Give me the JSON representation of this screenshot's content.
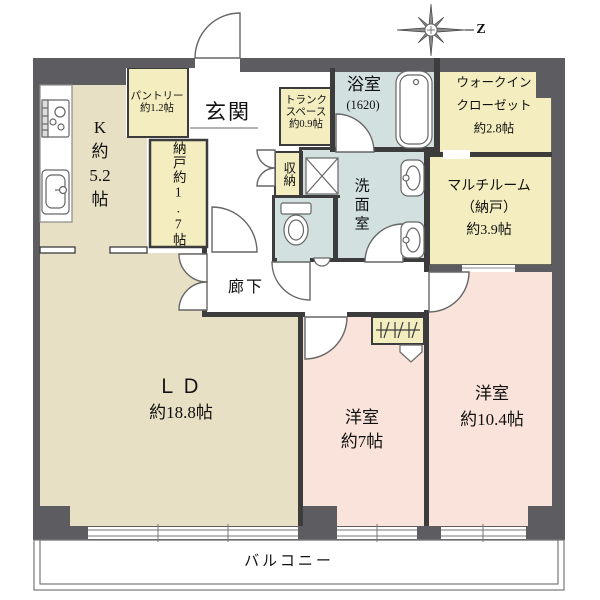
{
  "palette": {
    "wall": "#5d5d61",
    "iwall": "#3c3c3c",
    "beige": "#e7e0c5",
    "yellow": "#f3edbf",
    "blue": "#d2e0e0",
    "pink": "#fae3da",
    "fixture_line": "#666666"
  },
  "compass": {
    "north_label": "Z"
  },
  "rooms": {
    "kitchen": {
      "lines": [
        "K",
        "約",
        "5.2",
        "帖"
      ]
    },
    "pantry": {
      "line1": "パントリー",
      "line2": "約1.2帖"
    },
    "entrance": {
      "label": "玄関"
    },
    "trunk": {
      "line1": "トランク",
      "line2": "スペース",
      "line3": "約0.9帖"
    },
    "bathroom": {
      "label": "浴室",
      "size": "(1620)"
    },
    "walk_in_closet": {
      "line1": "ウォークイン",
      "line2": "クローゼット",
      "line3": "約2.8帖"
    },
    "storeroom": {
      "label": "納戸約1.7帖"
    },
    "closet": {
      "label": "収納"
    },
    "washroom": {
      "label": "洗面室"
    },
    "multiroom": {
      "line1": "マルチルーム",
      "line2": "（納戸）",
      "line3": "約3.9帖"
    },
    "corridor": {
      "label": "廊下"
    },
    "living_dining": {
      "line1": "ＬＤ",
      "line2": "約18.8帖"
    },
    "bedroom_7": {
      "line1": "洋室",
      "line2": "約7帖"
    },
    "bedroom_104": {
      "line1": "洋室",
      "line2": "約10.4帖"
    },
    "balcony": {
      "label": "バルコニー"
    }
  }
}
